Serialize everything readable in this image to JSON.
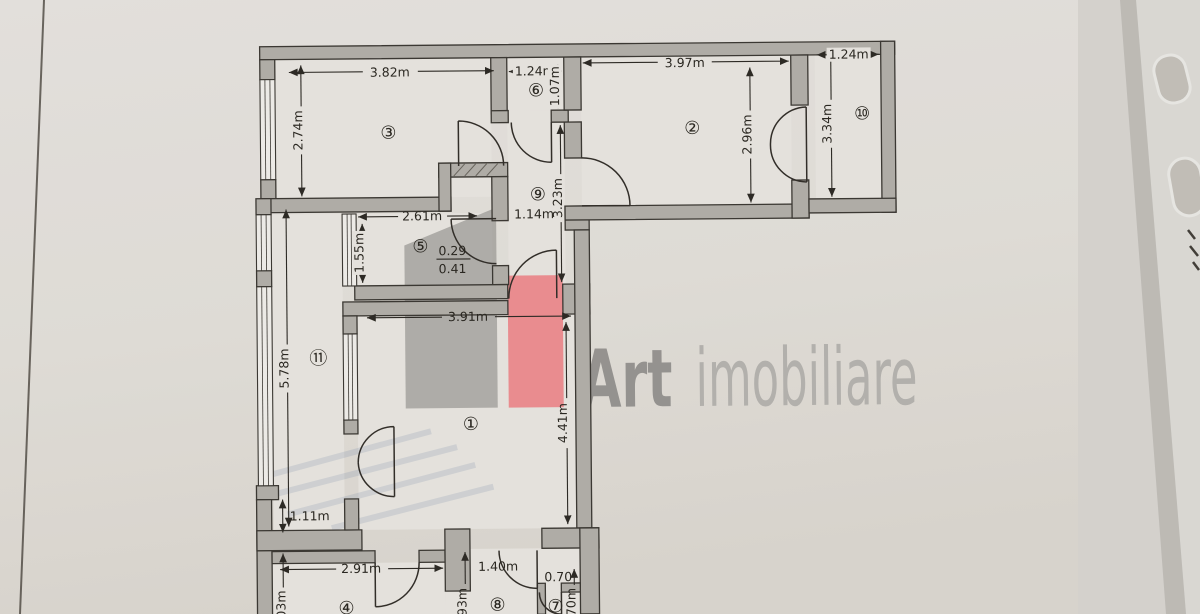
{
  "watermark": {
    "art": "Art",
    "imobiliare": "imobiliare",
    "gray": "#8f8d8a",
    "red": "#f2797d",
    "art_color": "#92908d",
    "imobiliare_color": "#b4b2ae"
  },
  "rooms": {
    "n1": "①",
    "n2": "②",
    "n3": "③",
    "n4": "④",
    "n5": "⑤",
    "n6": "⑥",
    "n7": "⑦",
    "n8": "⑧",
    "n9": "⑨",
    "n10": "⑩",
    "n11": "⑪"
  },
  "dims": {
    "room3_w": "3.82m",
    "room3_h": "2.74m",
    "room6_w": "1.24m",
    "room6_h": "1.07m",
    "room2_w": "3.97m",
    "room2_h": "2.96m",
    "room10_w": "1.24m",
    "room10_h": "3.34m",
    "hall_w": "1.14m",
    "hall_h": "3.23m",
    "room5_w": "2.61m",
    "room5_h": "1.55m",
    "frac_top": "0.29",
    "frac_bot": "0.41",
    "room1_w": "3.91m",
    "room1_h": "4.41m",
    "balcony_h": "5.78m",
    "wall_seg": "1.11m",
    "room4_w": "2.91m",
    "passage_w": "1.40m",
    "room7_w": "0.70",
    "room4_h_part": "03m",
    "room8_h_part": "93m",
    "room7_h_part": "70m"
  }
}
